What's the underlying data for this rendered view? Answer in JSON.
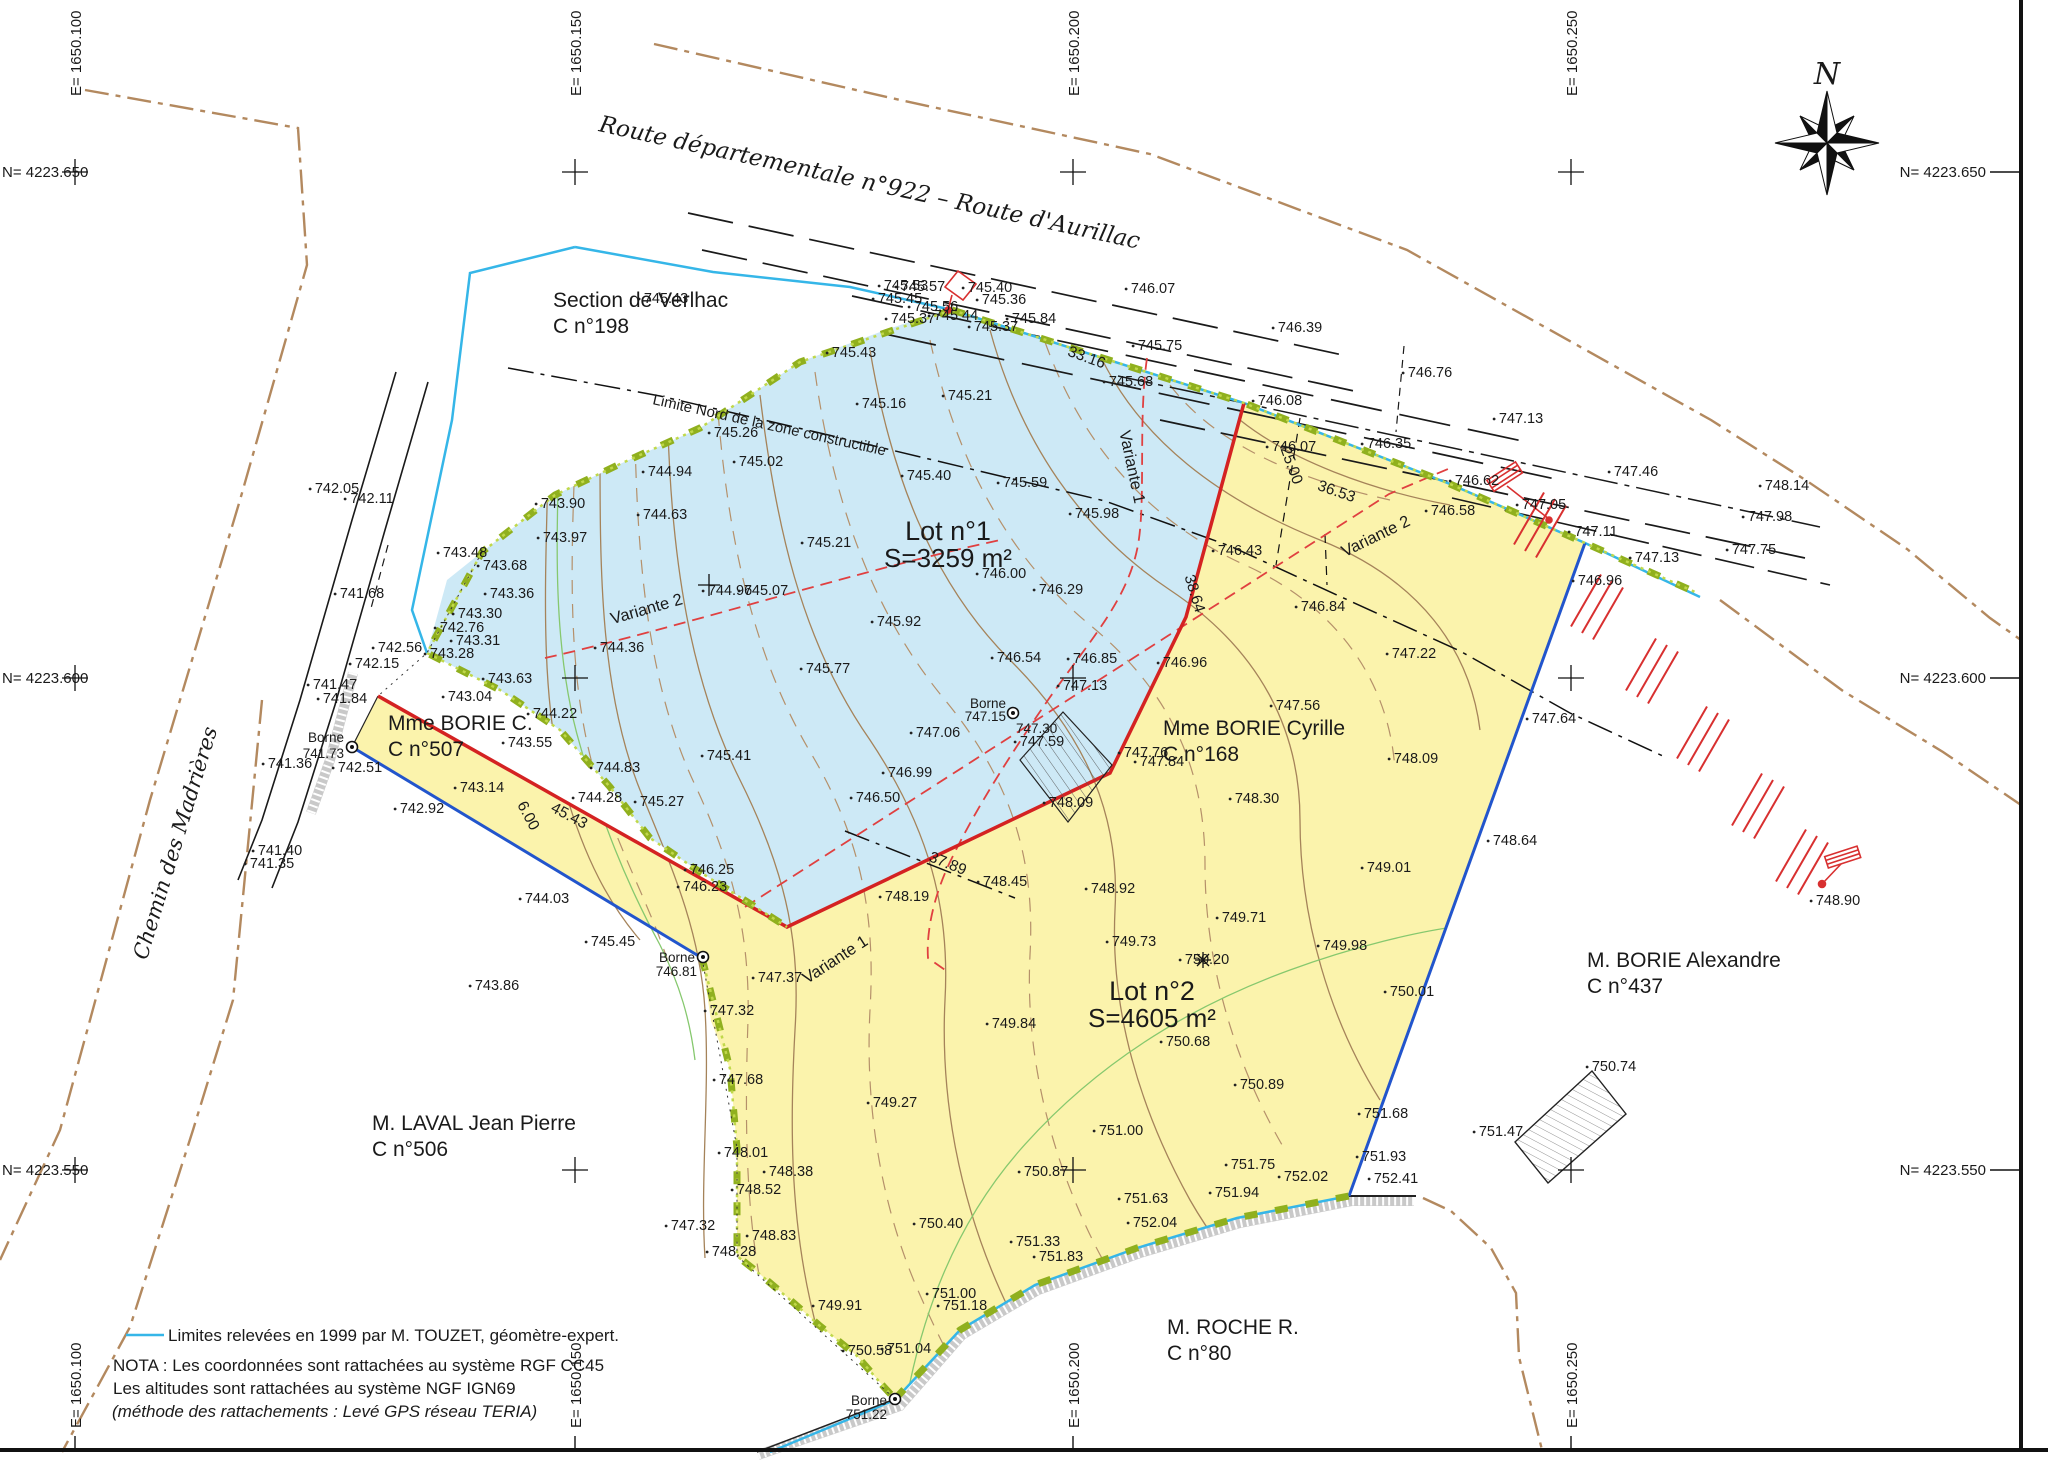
{
  "north_letter": "N",
  "roads": {
    "route_top": "Route départementale n°922  –  Route d'Aurillac",
    "chemin": "Chemin des Madrières"
  },
  "grid": {
    "e_labels": [
      {
        "t": "E= 1650.100",
        "x": 75
      },
      {
        "t": "E= 1650.150",
        "x": 575
      },
      {
        "t": "E= 1650.200",
        "x": 1073
      },
      {
        "t": "E= 1650.250",
        "x": 1571
      }
    ],
    "n_labels": [
      {
        "t": "N= 4223.650",
        "y": 172
      },
      {
        "t": "N= 4223.600",
        "y": 678
      },
      {
        "t": "N= 4223.550",
        "y": 1170
      }
    ]
  },
  "lots": [
    {
      "name": "Lot n°1",
      "area": "S=3259 m²",
      "x": 948,
      "y": 540
    },
    {
      "name": "Lot n°2",
      "area": "S=4605 m²",
      "x": 1152,
      "y": 1000
    }
  ],
  "parcels": [
    {
      "name": "Section de Verlhac",
      "ref": "C n°198",
      "x": 553,
      "y": 307
    },
    {
      "name": "Mme BORIE C.",
      "ref": "C n°507",
      "x": 388,
      "y": 730
    },
    {
      "name": "Mme BORIE Cyrille",
      "ref": "C n°168",
      "x": 1163,
      "y": 735
    },
    {
      "name": "M. LAVAL Jean Pierre",
      "ref": "C n°506",
      "x": 372,
      "y": 1130
    },
    {
      "name": "M. BORIE Alexandre",
      "ref": "C n°437",
      "x": 1587,
      "y": 967
    },
    {
      "name": "M. ROCHE R.",
      "ref": "C n°80",
      "x": 1167,
      "y": 1334
    }
  ],
  "bornes": [
    {
      "x": 352,
      "y": 747,
      "texts": [
        {
          "t": "Borne",
          "x": 344,
          "y": 742,
          "a": "end"
        },
        {
          "t": "741.73",
          "x": 344,
          "y": 758,
          "a": "end"
        }
      ]
    },
    {
      "x": 1013,
      "y": 713,
      "texts": [
        {
          "t": "Borne",
          "x": 1006,
          "y": 708,
          "a": "end"
        },
        {
          "t": "747.15",
          "x": 1006,
          "y": 721,
          "a": "end"
        },
        {
          "t": "747.30",
          "x": 1016,
          "y": 733,
          "a": "start"
        }
      ]
    },
    {
      "x": 703,
      "y": 957,
      "texts": [
        {
          "t": "Borne",
          "x": 695,
          "y": 962,
          "a": "end"
        },
        {
          "t": "746.81",
          "x": 697,
          "y": 976,
          "a": "end"
        }
      ]
    },
    {
      "x": 895,
      "y": 1399,
      "texts": [
        {
          "t": "Borne",
          "x": 887,
          "y": 1405,
          "a": "end"
        },
        {
          "t": "751.22",
          "x": 887,
          "y": 1419,
          "a": "end"
        }
      ]
    }
  ],
  "dimensions": [
    {
      "t": "33.16",
      "x": 1085,
      "y": 362,
      "r": 20,
      "c": "#d03030"
    },
    {
      "t": "36.53",
      "x": 1335,
      "y": 496,
      "r": 19,
      "c": "#d03030"
    },
    {
      "t": "38.64",
      "x": 1190,
      "y": 595,
      "r": 73,
      "c": "#d03030"
    },
    {
      "t": "37.89",
      "x": 946,
      "y": 868,
      "r": 22,
      "c": "#d03030"
    },
    {
      "t": "45.43",
      "x": 567,
      "y": 820,
      "r": 28,
      "c": "#d03030"
    },
    {
      "t": "6.00",
      "x": 524,
      "y": 818,
      "r": 62,
      "c": "#d03030"
    },
    {
      "t": "25.00",
      "x": 1287,
      "y": 467,
      "r": 70,
      "c": "#1a1a1a"
    }
  ],
  "variantes": [
    {
      "t": "Variante 1",
      "x": 1127,
      "y": 468,
      "r": 78
    },
    {
      "t": "Variante 1",
      "x": 838,
      "y": 964,
      "r": -33
    },
    {
      "t": "Variante 2",
      "x": 1378,
      "y": 541,
      "r": -26
    },
    {
      "t": "Variante 2",
      "x": 648,
      "y": 614,
      "r": -16
    }
  ],
  "limite_nord": {
    "t": "Limite Nord de la zone constructible",
    "x": 652,
    "y": 404,
    "r": 12.5
  },
  "legend": {
    "limits": "Limites relevées en 1999 par M. TOUZET, géomètre-expert.",
    "nota1": "NOTA : Les coordonnées sont rattachées au système RGF CC45",
    "nota2": "Les altitudes sont rattachées au système NGF IGN69",
    "nota3": "(méthode des rattachements : Levé GPS réseau TERIA)"
  },
  "spot_elevations": [
    {
      "t": "745.57",
      "x": 923,
      "y": 291
    },
    {
      "t": "745.84",
      "x": 1034,
      "y": 323
    },
    {
      "t": "746.07",
      "x": 1153,
      "y": 293
    },
    {
      "t": "746.39",
      "x": 1300,
      "y": 332
    },
    {
      "t": "746.76",
      "x": 1430,
      "y": 377
    },
    {
      "t": "747.13",
      "x": 1521,
      "y": 423
    },
    {
      "t": "747.46",
      "x": 1636,
      "y": 476
    },
    {
      "t": "748.14",
      "x": 1787,
      "y": 490
    },
    {
      "t": "747.98",
      "x": 1770,
      "y": 521
    },
    {
      "t": "747.75",
      "x": 1754,
      "y": 554
    },
    {
      "t": "745.53",
      "x": 906,
      "y": 290
    },
    {
      "t": "745.45",
      "x": 900,
      "y": 303
    },
    {
      "t": "745.56",
      "x": 936,
      "y": 311
    },
    {
      "t": "745.44",
      "x": 956,
      "y": 320
    },
    {
      "t": "745.40",
      "x": 990,
      "y": 292
    },
    {
      "t": "745.36",
      "x": 1004,
      "y": 304
    },
    {
      "t": "745.37",
      "x": 913,
      "y": 323
    },
    {
      "t": "745.37",
      "x": 996,
      "y": 331
    },
    {
      "t": "745.75",
      "x": 1160,
      "y": 350
    },
    {
      "t": "745.68",
      "x": 1131,
      "y": 386
    },
    {
      "t": "746.08",
      "x": 1280,
      "y": 405
    },
    {
      "t": "746.07",
      "x": 1294,
      "y": 451
    },
    {
      "t": "746.35",
      "x": 1389,
      "y": 448
    },
    {
      "t": "746.62",
      "x": 1477,
      "y": 485
    },
    {
      "t": "746.58",
      "x": 1453,
      "y": 515
    },
    {
      "t": "747.05",
      "x": 1544,
      "y": 509
    },
    {
      "t": "747.11",
      "x": 1596,
      "y": 536
    },
    {
      "t": "747.13",
      "x": 1657,
      "y": 562
    },
    {
      "t": "746.96",
      "x": 1600,
      "y": 585
    },
    {
      "t": "747.22",
      "x": 1414,
      "y": 658
    },
    {
      "t": "747.64",
      "x": 1554,
      "y": 723
    },
    {
      "t": "748.64",
      "x": 1515,
      "y": 845
    },
    {
      "t": "748.90",
      "x": 1838,
      "y": 905
    },
    {
      "t": "745.43",
      "x": 666,
      "y": 303
    },
    {
      "t": "745.43",
      "x": 854,
      "y": 357
    },
    {
      "t": "745.26",
      "x": 736,
      "y": 437
    },
    {
      "t": "745.02",
      "x": 761,
      "y": 466
    },
    {
      "t": "744.94",
      "x": 670,
      "y": 476
    },
    {
      "t": "744.63",
      "x": 665,
      "y": 519
    },
    {
      "t": "743.90",
      "x": 563,
      "y": 508
    },
    {
      "t": "743.97",
      "x": 565,
      "y": 542
    },
    {
      "t": "745.16",
      "x": 884,
      "y": 408
    },
    {
      "t": "745.21",
      "x": 970,
      "y": 400
    },
    {
      "t": "745.40",
      "x": 929,
      "y": 480
    },
    {
      "t": "745.59",
      "x": 1025,
      "y": 487
    },
    {
      "t": "745.21",
      "x": 829,
      "y": 547
    },
    {
      "t": "745.98",
      "x": 1097,
      "y": 518
    },
    {
      "t": "744.96",
      "x": 730,
      "y": 595
    },
    {
      "t": "745.07",
      "x": 766,
      "y": 595
    },
    {
      "t": "746.00",
      "x": 1004,
      "y": 578
    },
    {
      "t": "746.29",
      "x": 1061,
      "y": 594
    },
    {
      "t": "742.05",
      "x": 337,
      "y": 493
    },
    {
      "t": "742.11",
      "x": 372,
      "y": 503
    },
    {
      "t": "741.68",
      "x": 362,
      "y": 598
    },
    {
      "t": "742.56",
      "x": 400,
      "y": 652
    },
    {
      "t": "742.15",
      "x": 377,
      "y": 668
    },
    {
      "t": "741.47",
      "x": 335,
      "y": 689
    },
    {
      "t": "741.84",
      "x": 345,
      "y": 703
    },
    {
      "t": "741.36",
      "x": 290,
      "y": 768
    },
    {
      "t": "742.51",
      "x": 360,
      "y": 772
    },
    {
      "t": "741.40",
      "x": 280,
      "y": 855
    },
    {
      "t": "741.35",
      "x": 272,
      "y": 868
    },
    {
      "t": "743.48",
      "x": 465,
      "y": 557
    },
    {
      "t": "743.68",
      "x": 505,
      "y": 570
    },
    {
      "t": "743.36",
      "x": 512,
      "y": 598
    },
    {
      "t": "743.30",
      "x": 480,
      "y": 618
    },
    {
      "t": "742.76",
      "x": 462,
      "y": 632
    },
    {
      "t": "743.31",
      "x": 478,
      "y": 645
    },
    {
      "t": "743.28",
      "x": 452,
      "y": 658
    },
    {
      "t": "743.04",
      "x": 470,
      "y": 701
    },
    {
      "t": "743.63",
      "x": 510,
      "y": 683
    },
    {
      "t": "744.22",
      "x": 555,
      "y": 718
    },
    {
      "t": "743.55",
      "x": 530,
      "y": 747
    },
    {
      "t": "744.36",
      "x": 622,
      "y": 652
    },
    {
      "t": "744.83",
      "x": 618,
      "y": 772
    },
    {
      "t": "744.28",
      "x": 600,
      "y": 802
    },
    {
      "t": "743.14",
      "x": 482,
      "y": 792
    },
    {
      "t": "742.92",
      "x": 422,
      "y": 813
    },
    {
      "t": "744.03",
      "x": 547,
      "y": 903
    },
    {
      "t": "745.45",
      "x": 613,
      "y": 946
    },
    {
      "t": "743.86",
      "x": 497,
      "y": 990
    },
    {
      "t": "745.92",
      "x": 899,
      "y": 626
    },
    {
      "t": "745.77",
      "x": 828,
      "y": 673
    },
    {
      "t": "746.54",
      "x": 1019,
      "y": 662
    },
    {
      "t": "746.85",
      "x": 1095,
      "y": 663
    },
    {
      "t": "747.06",
      "x": 938,
      "y": 737
    },
    {
      "t": "746.99",
      "x": 910,
      "y": 777
    },
    {
      "t": "745.41",
      "x": 729,
      "y": 760
    },
    {
      "t": "745.27",
      "x": 662,
      "y": 806
    },
    {
      "t": "746.50",
      "x": 878,
      "y": 802
    },
    {
      "t": "746.25",
      "x": 712,
      "y": 874
    },
    {
      "t": "746.23",
      "x": 705,
      "y": 891
    },
    {
      "t": "748.19",
      "x": 907,
      "y": 901
    },
    {
      "t": "748.45",
      "x": 1005,
      "y": 886
    },
    {
      "t": "747.13",
      "x": 1085,
      "y": 690
    },
    {
      "t": "747.59",
      "x": 1042,
      "y": 746
    },
    {
      "t": "747.76",
      "x": 1146,
      "y": 757
    },
    {
      "t": "747.84",
      "x": 1162,
      "y": 766
    },
    {
      "t": "748.09",
      "x": 1071,
      "y": 807
    },
    {
      "t": "747.56",
      "x": 1298,
      "y": 710
    },
    {
      "t": "748.09",
      "x": 1416,
      "y": 763
    },
    {
      "t": "748.30",
      "x": 1257,
      "y": 803
    },
    {
      "t": "748.92",
      "x": 1113,
      "y": 893
    },
    {
      "t": "749.01",
      "x": 1389,
      "y": 872
    },
    {
      "t": "746.43",
      "x": 1240,
      "y": 555
    },
    {
      "t": "746.84",
      "x": 1323,
      "y": 611
    },
    {
      "t": "746.96",
      "x": 1185,
      "y": 667
    },
    {
      "t": "749.71",
      "x": 1244,
      "y": 922
    },
    {
      "t": "749.73",
      "x": 1134,
      "y": 946
    },
    {
      "t": "750.20",
      "x": 1207,
      "y": 964
    },
    {
      "t": "749.84",
      "x": 1014,
      "y": 1028
    },
    {
      "t": "750.68",
      "x": 1188,
      "y": 1046
    },
    {
      "t": "749.27",
      "x": 895,
      "y": 1107
    },
    {
      "t": "751.00",
      "x": 1121,
      "y": 1135
    },
    {
      "t": "748.01",
      "x": 746,
      "y": 1157
    },
    {
      "t": "748.38",
      "x": 791,
      "y": 1176
    },
    {
      "t": "748.52",
      "x": 759,
      "y": 1194
    },
    {
      "t": "750.87",
      "x": 1046,
      "y": 1176
    },
    {
      "t": "747.68",
      "x": 741,
      "y": 1084
    },
    {
      "t": "747.37",
      "x": 780,
      "y": 982
    },
    {
      "t": "747.32",
      "x": 732,
      "y": 1015
    },
    {
      "t": "747.32",
      "x": 693,
      "y": 1230
    },
    {
      "t": "748.83",
      "x": 774,
      "y": 1240
    },
    {
      "t": "748.28",
      "x": 734,
      "y": 1256
    },
    {
      "t": "750.40",
      "x": 941,
      "y": 1228
    },
    {
      "t": "749.91",
      "x": 840,
      "y": 1310
    },
    {
      "t": "751.33",
      "x": 1038,
      "y": 1246
    },
    {
      "t": "751.83",
      "x": 1061,
      "y": 1261
    },
    {
      "t": "751.63",
      "x": 1146,
      "y": 1203
    },
    {
      "t": "752.04",
      "x": 1155,
      "y": 1227
    },
    {
      "t": "751.00",
      "x": 954,
      "y": 1298
    },
    {
      "t": "751.18",
      "x": 965,
      "y": 1310
    },
    {
      "t": "750.58",
      "x": 870,
      "y": 1355
    },
    {
      "t": "751.04",
      "x": 909,
      "y": 1353
    },
    {
      "t": "749.98",
      "x": 1345,
      "y": 950
    },
    {
      "t": "750.01",
      "x": 1412,
      "y": 996
    },
    {
      "t": "750.89",
      "x": 1262,
      "y": 1089
    },
    {
      "t": "751.68",
      "x": 1386,
      "y": 1118
    },
    {
      "t": "751.75",
      "x": 1253,
      "y": 1169
    },
    {
      "t": "752.02",
      "x": 1306,
      "y": 1181
    },
    {
      "t": "751.93",
      "x": 1384,
      "y": 1161
    },
    {
      "t": "752.41",
      "x": 1396,
      "y": 1183
    },
    {
      "t": "751.94",
      "x": 1237,
      "y": 1197
    },
    {
      "t": "750.74",
      "x": 1614,
      "y": 1071
    },
    {
      "t": "751.47",
      "x": 1501,
      "y": 1136
    }
  ]
}
